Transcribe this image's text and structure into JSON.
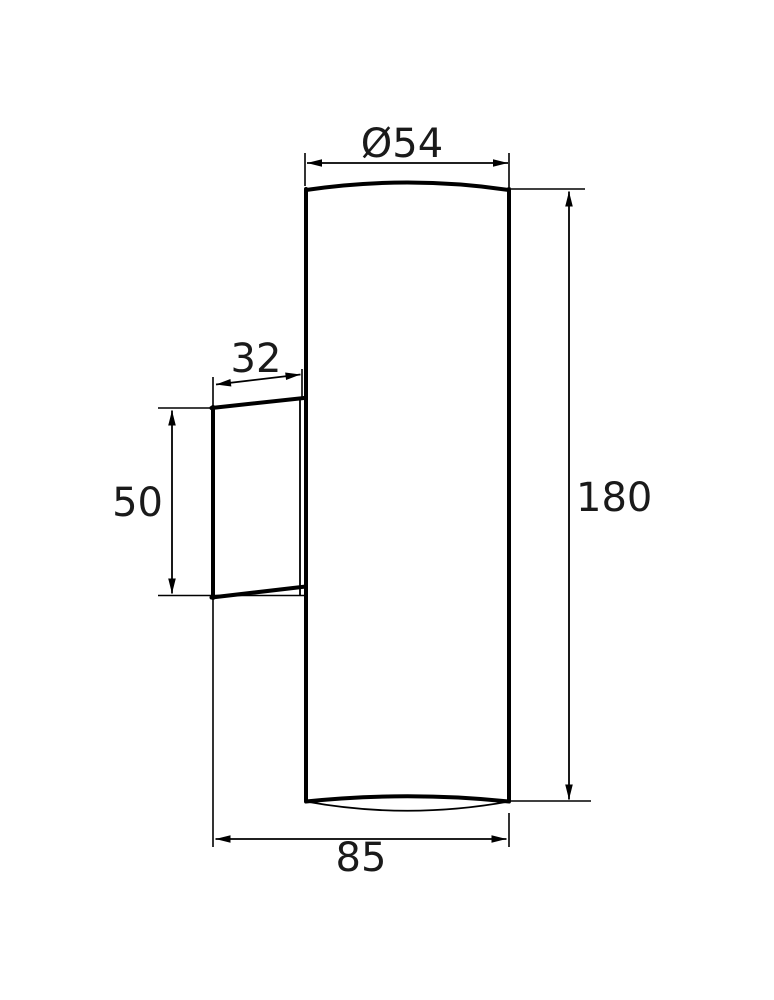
{
  "drawing": {
    "description": "wall-luminaire-dimension-drawing",
    "colors": {
      "line": "#000000",
      "background": "#ffffff"
    },
    "dimensions": {
      "diameter_top": "Ø54",
      "overall_height": "180",
      "bracket_width": "32",
      "bracket_height": "50",
      "overall_depth": "85"
    }
  }
}
